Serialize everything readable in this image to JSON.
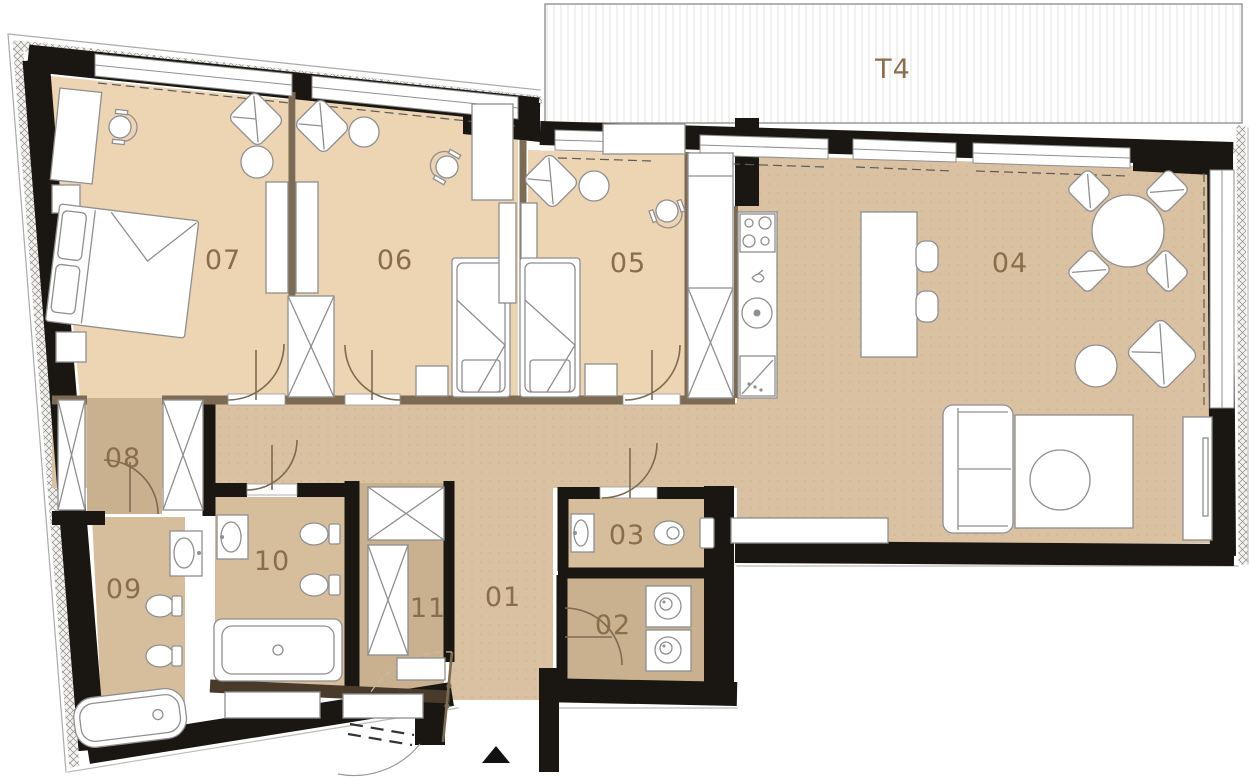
{
  "plan": {
    "title": "Apartment floor plan",
    "terrace": {
      "label": "T4"
    },
    "rooms": [
      {
        "label": "01"
      },
      {
        "label": "02"
      },
      {
        "label": "03"
      },
      {
        "label": "04"
      },
      {
        "label": "05"
      },
      {
        "label": "06"
      },
      {
        "label": "07"
      },
      {
        "label": "08"
      },
      {
        "label": "09"
      },
      {
        "label": "10"
      },
      {
        "label": "11"
      }
    ],
    "colors": {
      "bedroom_floor": "#EDD4B2",
      "living_floor": "#D9C1A1",
      "bath_floor": "#D6BD9C",
      "utility_floor": "#C9B18F",
      "wall": "#1A1611",
      "wood_partition": "#7D6A52",
      "label_text": "#8A6D4B",
      "furniture_line": "#8F8F8F"
    }
  }
}
